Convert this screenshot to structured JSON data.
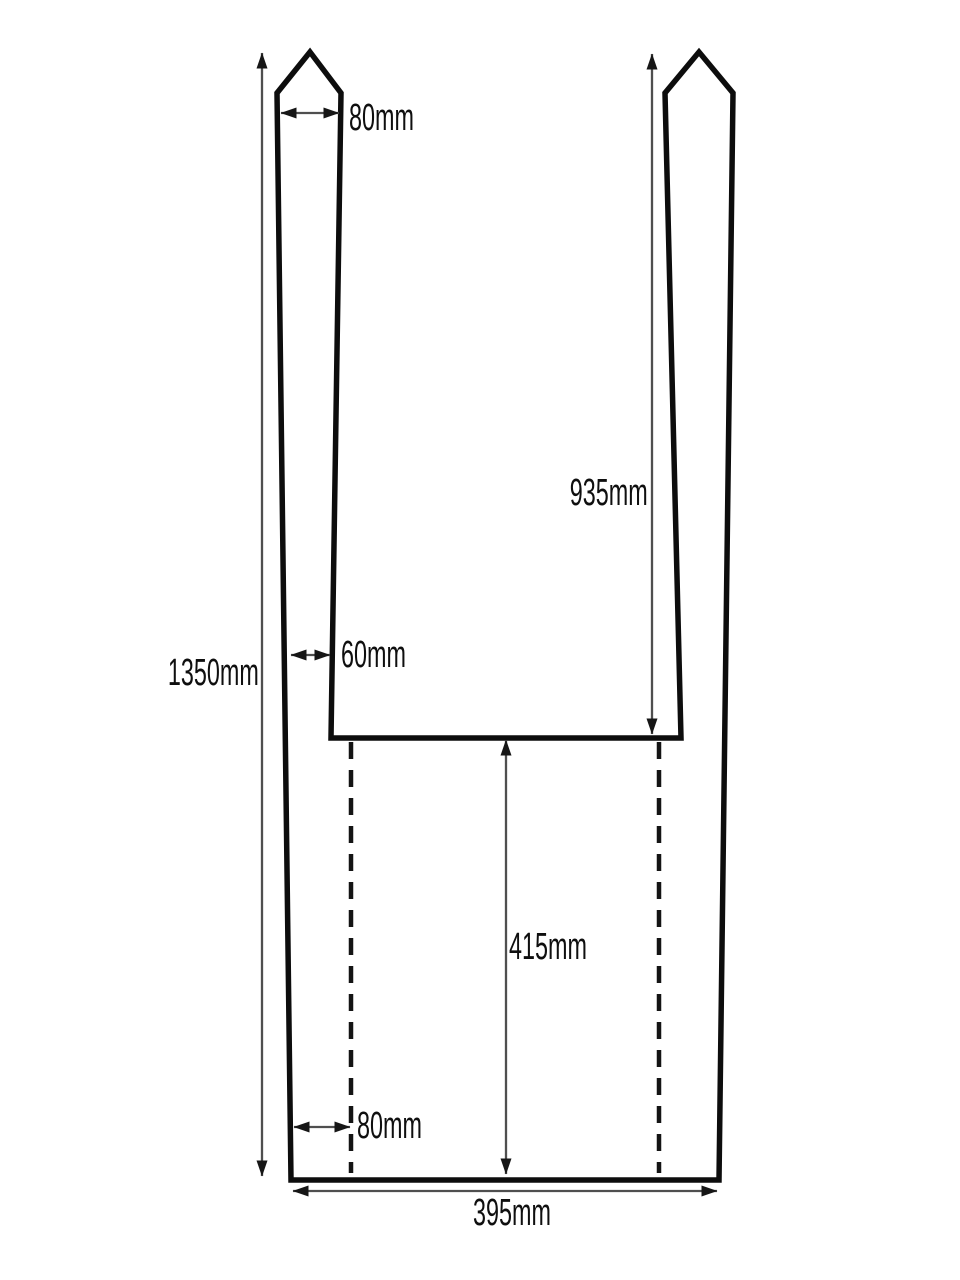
{
  "diagram": {
    "type": "technical-dimension-drawing",
    "background": "#ffffff",
    "line_color": "#0d0d0d",
    "fold_line_color": "#141414",
    "dim_line_color": "#4f4f4f",
    "arrow_color": "#161616",
    "text_color": "#0f0f0f",
    "dimensions": {
      "strap_top_width": "80mm",
      "opening_depth": "935mm",
      "strap_bottom_width": "60mm",
      "total_height": "1350mm",
      "lower_section_height": "415mm",
      "bottom_fold_offset": "80mm",
      "total_width": "395mm"
    }
  }
}
